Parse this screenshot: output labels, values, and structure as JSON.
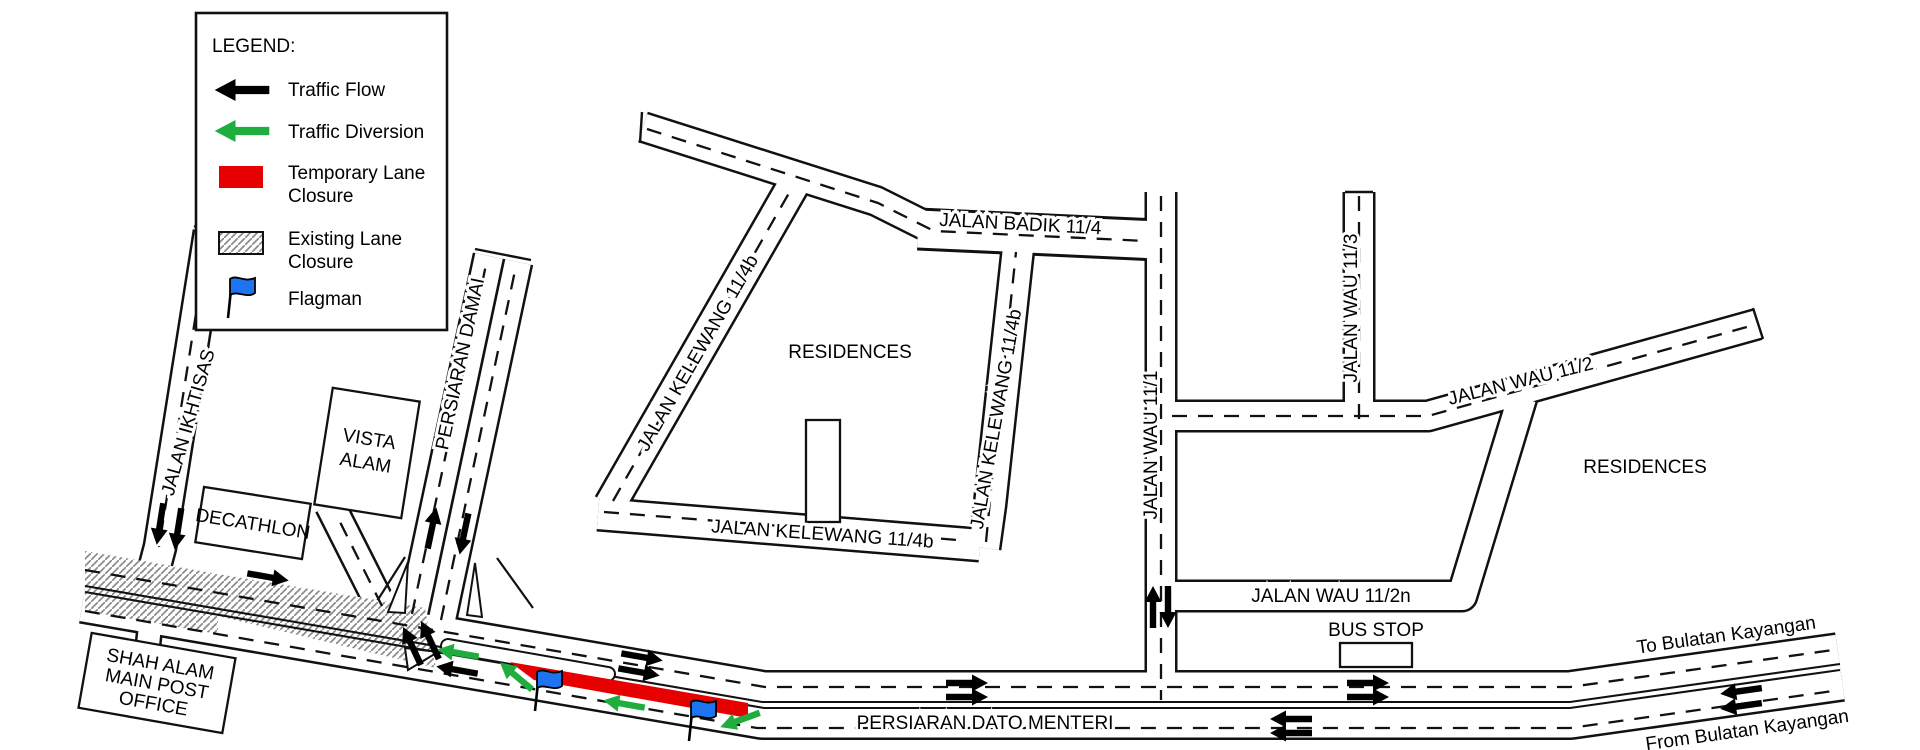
{
  "colors": {
    "road_outline": "#111111",
    "traffic_flow_arrow": "#000000",
    "traffic_diversion_arrow": "#1fae3e",
    "temporary_lane_closure": "#e60000",
    "flagman_flag": "#1e74f0",
    "existing_lane_closure_hatch": "#8c8c8c"
  },
  "legend": {
    "title": "LEGEND:",
    "items": [
      {
        "icon": "black-arrow-icon",
        "label": "Traffic Flow"
      },
      {
        "icon": "green-arrow-icon",
        "label": "Traffic Diversion"
      },
      {
        "icon": "red-swatch-icon",
        "line1": "Temporary Lane",
        "line2": "Closure"
      },
      {
        "icon": "hatch-swatch-icon",
        "line1": "Existing Lane",
        "line2": "Closure"
      },
      {
        "icon": "flagman-flag-icon",
        "label": "Flagman"
      }
    ]
  },
  "roads": {
    "jalan_ikhtisas": "JALAN IKHTISAS",
    "persiaran_damai": "PERSIARAN DAMAI",
    "jalan_kelewang_11_4b": "JALAN KELEWANG 11/4b",
    "jalan_badik_11_4": "JALAN BADIK 11/4",
    "jalan_wau_11_1": "JALAN WAU 11/1",
    "jalan_wau_11_2": "JALAN WAU 11/2",
    "jalan_wau_11_2n": "JALAN WAU 11/2n",
    "jalan_wau_11_3": "JALAN WAU 11/3",
    "persiaran_dato_menteri": "PERSIARAN DATO MENTERI"
  },
  "places": {
    "vista_alam_line1": "VISTA",
    "vista_alam_line2": "ALAM",
    "decathlon": "DECATHLON",
    "post_office_line1": "SHAH ALAM",
    "post_office_line2": "MAIN POST",
    "post_office_line3": "OFFICE",
    "residences_west": "RESIDENCES",
    "residences_east": "RESIDENCES",
    "bus_stop": "BUS STOP"
  },
  "directions": {
    "to_bulatan_kayangan": "To Bulatan Kayangan",
    "from_bulatan_kayangan": "From Bulatan Kayangan"
  }
}
